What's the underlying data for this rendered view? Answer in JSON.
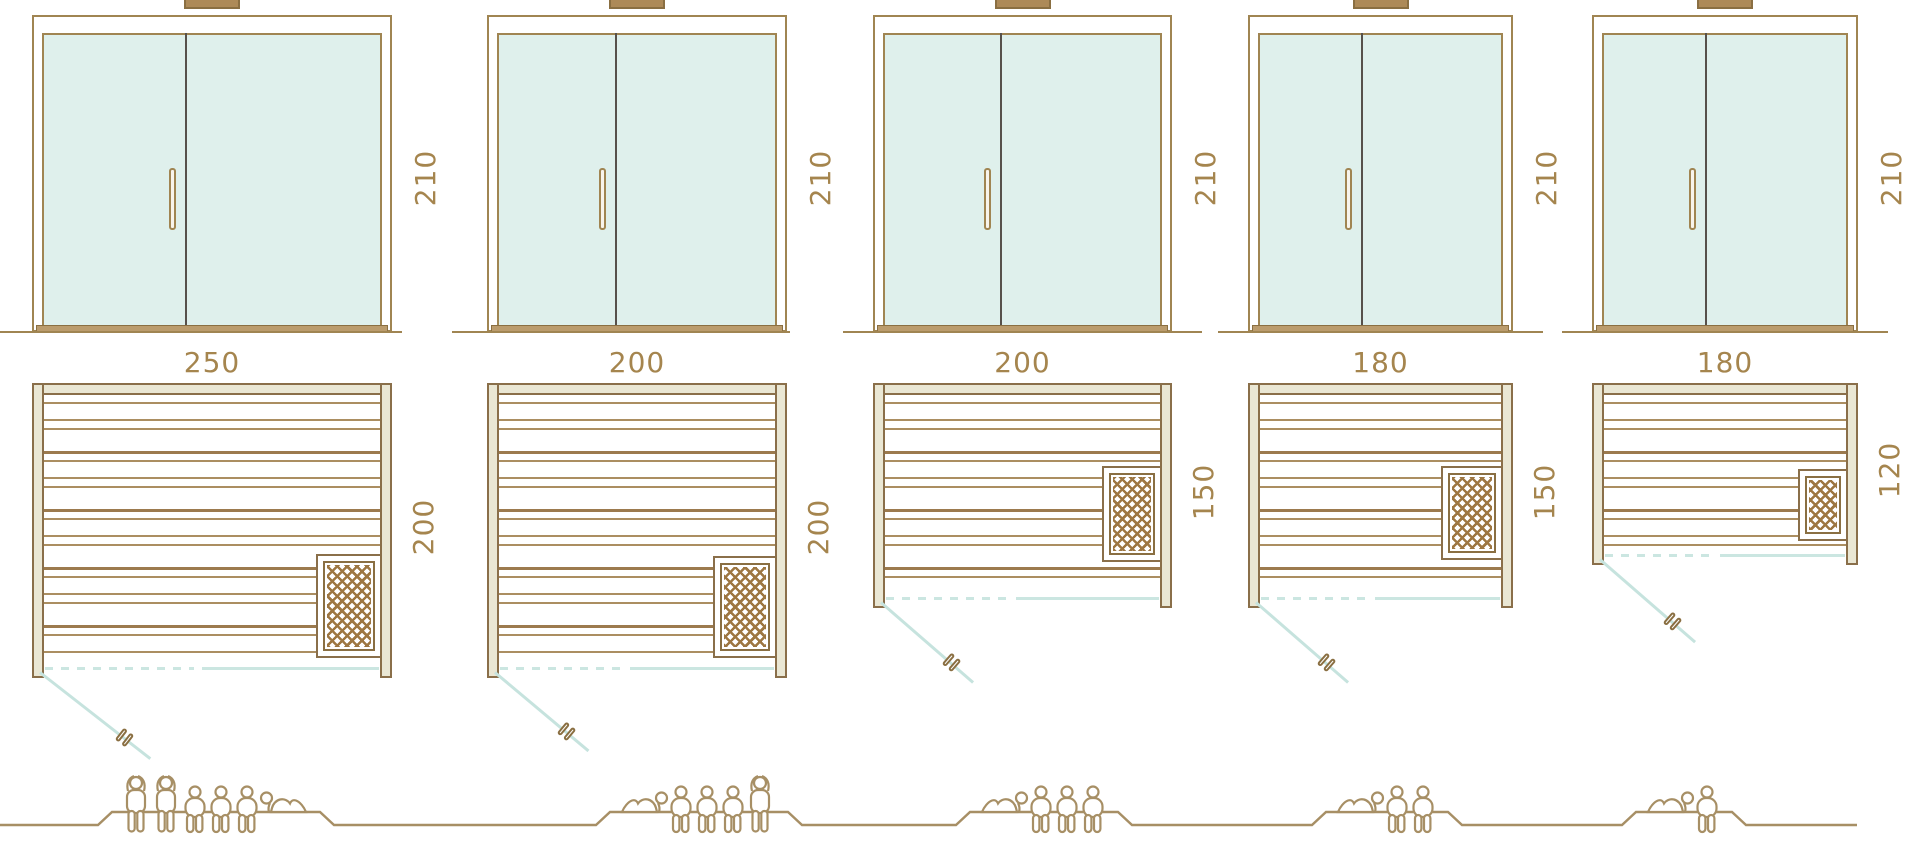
{
  "colors": {
    "outline_brown": "#a08552",
    "frame_dark": "#8a6f42",
    "dark_divider": "#57514b",
    "glass_teal": "#dff0ec",
    "handle_cream": "#f8f4ec",
    "sill_brown": "#bb9c6d",
    "cap_brown": "#ad8a58",
    "label_brown": "#a5854e",
    "wall_beige": "#eae7d4",
    "wall_stroke": "#8a6f4a",
    "slat_brown": "#ab8e61",
    "slat_dark": "#9c7a4e",
    "heater_hatch": "#9e7742",
    "teal_line": "#cbe6e1",
    "teal_swing": "#c6e3de",
    "figure_brown": "#a78f65"
  },
  "columns": [
    {
      "door_height_cm": "210",
      "width_cm": "250",
      "depth_cm": "200",
      "capacity_figures": [
        "standing",
        "standing",
        "seated",
        "seated",
        "seated",
        "lying"
      ]
    },
    {
      "door_height_cm": "210",
      "width_cm": "200",
      "depth_cm": "200",
      "capacity_figures": [
        "lying",
        "seated",
        "seated",
        "seated",
        "standing"
      ]
    },
    {
      "door_height_cm": "210",
      "width_cm": "200",
      "depth_cm": "150",
      "capacity_figures": [
        "lying",
        "seated",
        "seated",
        "seated"
      ]
    },
    {
      "door_height_cm": "210",
      "width_cm": "180",
      "depth_cm": "150",
      "capacity_figures": [
        "lying",
        "seated",
        "seated"
      ]
    },
    {
      "door_height_cm": "210",
      "width_cm": "180",
      "depth_cm": "120",
      "capacity_figures": [
        "lying",
        "seated"
      ]
    }
  ]
}
